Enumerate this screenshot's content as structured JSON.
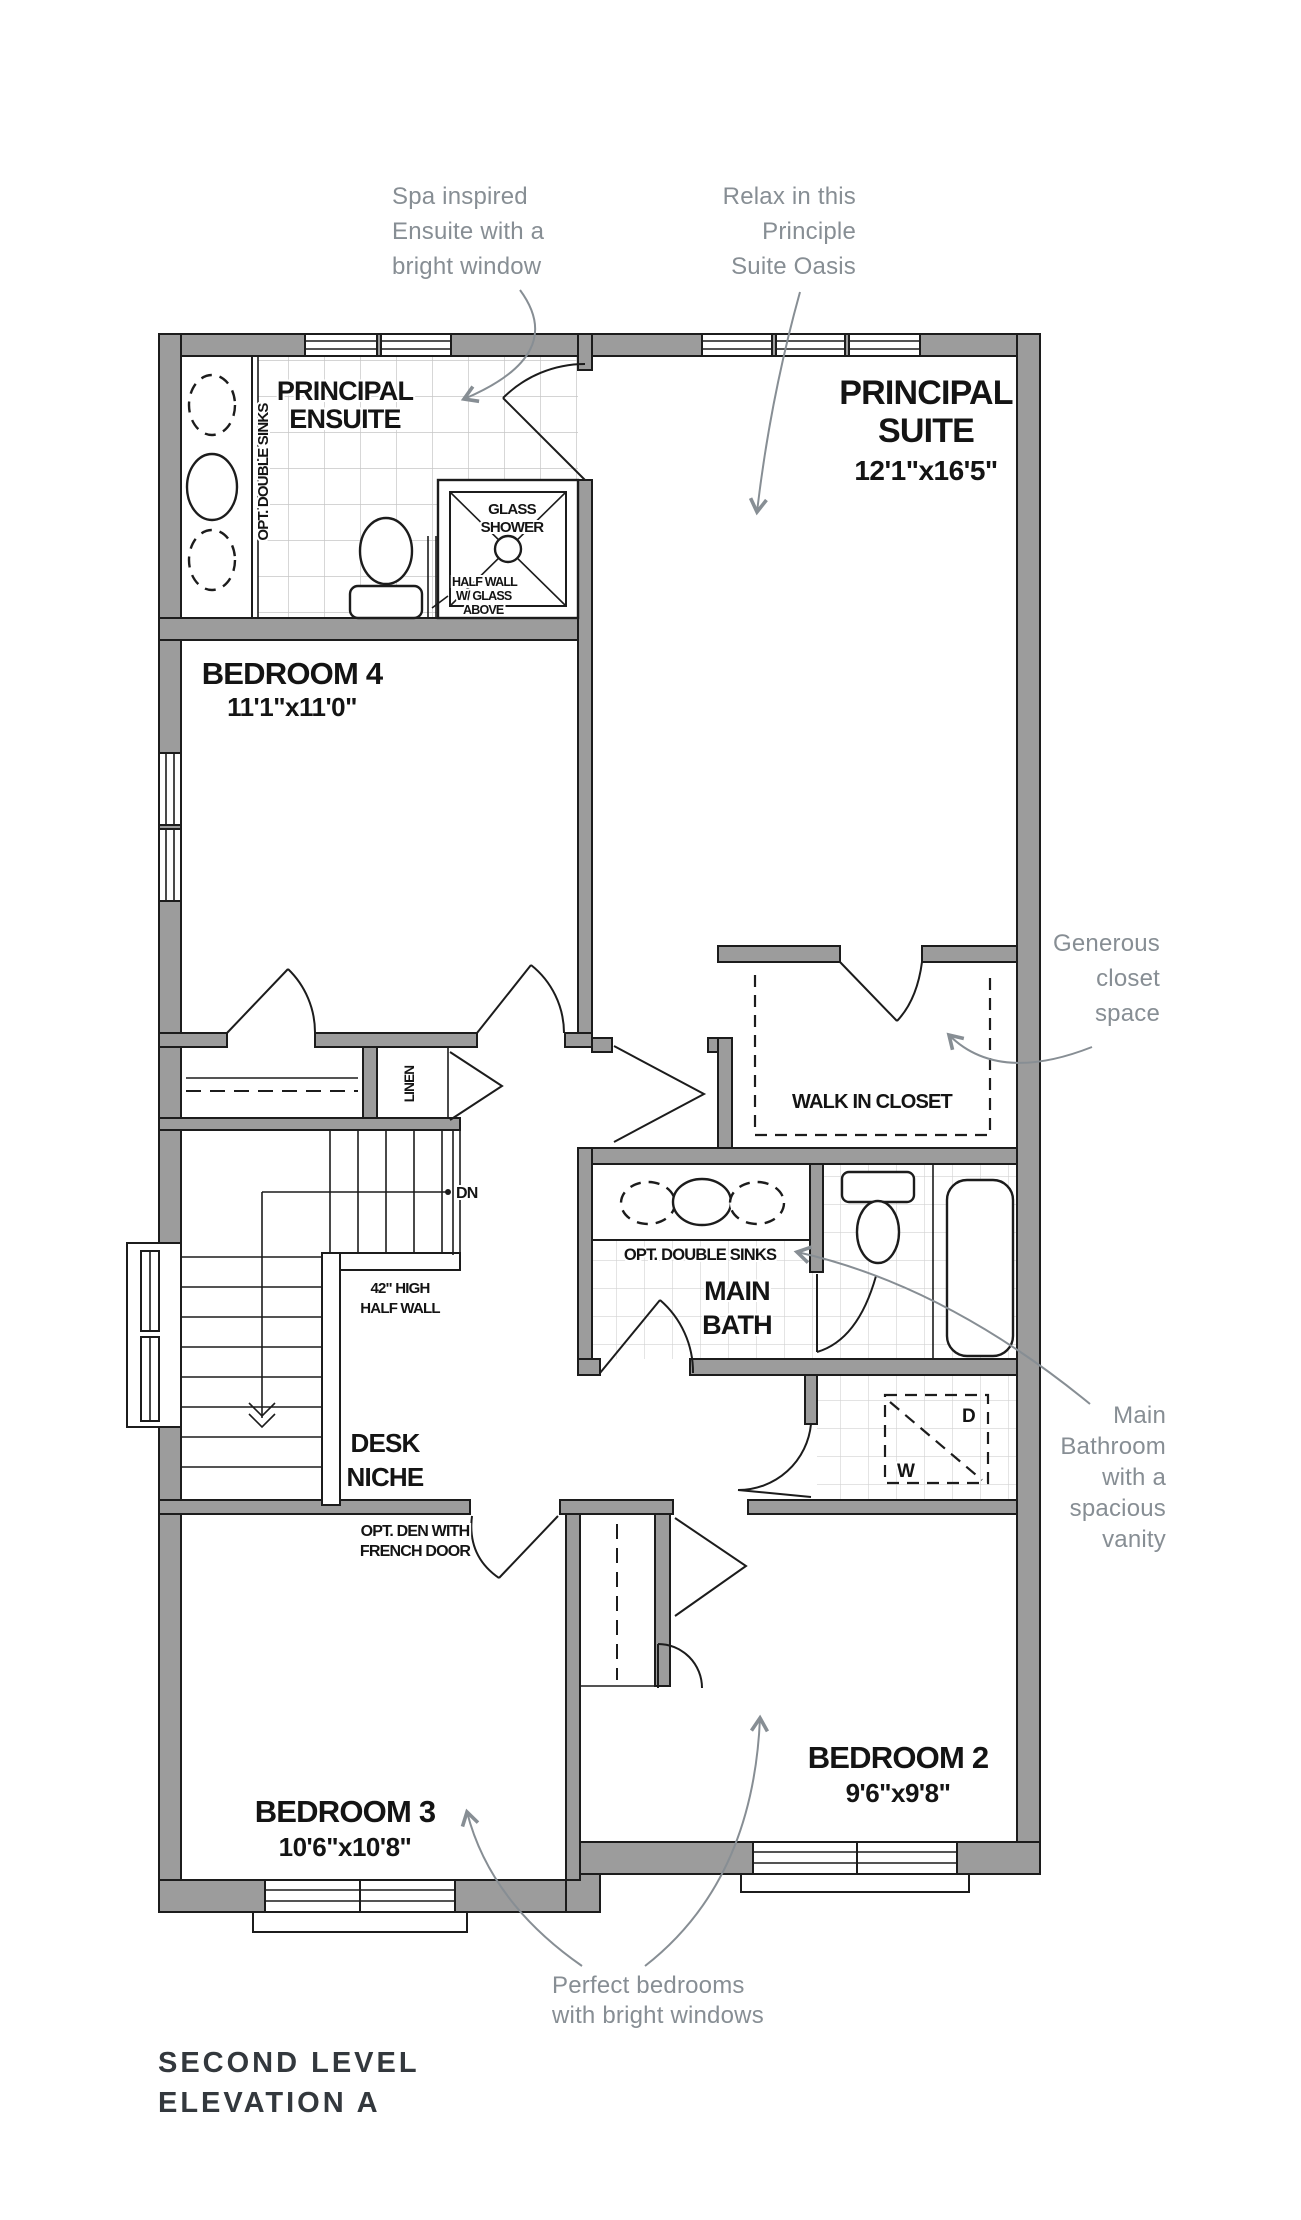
{
  "colors": {
    "wall": "#9c9c9c",
    "line": "#1c1c1c",
    "tile": "#c6c6c6",
    "annotation": "#878e94",
    "footer_text": "#33383d",
    "background": "#ffffff"
  },
  "plan": {
    "rooms": {
      "principal_ensuite": {
        "line1": "PRINCIPAL",
        "line2": "ENSUITE"
      },
      "principal_suite": {
        "line1": "PRINCIPAL",
        "line2": "SUITE",
        "dims": "12'1\"x16'5\""
      },
      "bedroom4": {
        "name": "BEDROOM 4",
        "dims": "11'1\"x11'0\""
      },
      "bedroom3": {
        "name": "BEDROOM 3",
        "dims": "10'6\"x10'8\""
      },
      "bedroom2": {
        "name": "BEDROOM 2",
        "dims": "9'6\"x9'8\""
      },
      "walk_in_closet": {
        "name": "WALK IN CLOSET"
      },
      "main_bath": {
        "line1": "MAIN",
        "line2": "BATH"
      },
      "desk_niche": {
        "line1": "DESK",
        "line2": "NICHE"
      },
      "linen": {
        "name": "LINEN"
      }
    },
    "features": {
      "opt_double_sinks_ensuite": "OPT. DOUBLE SINKS",
      "opt_double_sinks_bath": "OPT. DOUBLE SINKS",
      "glass_shower": {
        "line1": "GLASS",
        "line2": "SHOWER"
      },
      "half_wall_glass": {
        "line1": "HALF WALL",
        "line2": "W/ GLASS",
        "line3": "ABOVE"
      },
      "stairs_down": "DN",
      "half_wall_42": {
        "line1": "42\" HIGH",
        "line2": "HALF WALL"
      },
      "opt_den": {
        "line1": "OPT. DEN WITH",
        "line2": "FRENCH DOOR"
      },
      "washer": "W",
      "dryer": "D"
    }
  },
  "annotations": {
    "spa": [
      "Spa inspired",
      "Ensuite with a",
      "bright window"
    ],
    "relax": [
      "Relax in this",
      "Principle",
      "Suite Oasis"
    ],
    "closet": [
      "Generous",
      "closet",
      "space"
    ],
    "bath": [
      "Main",
      "Bathroom",
      "with a",
      "spacious",
      "vanity"
    ],
    "bedrooms": [
      "Perfect bedrooms",
      "with bright windows"
    ]
  },
  "footer": {
    "line1": "SECOND LEVEL",
    "line2": "ELEVATION A"
  }
}
